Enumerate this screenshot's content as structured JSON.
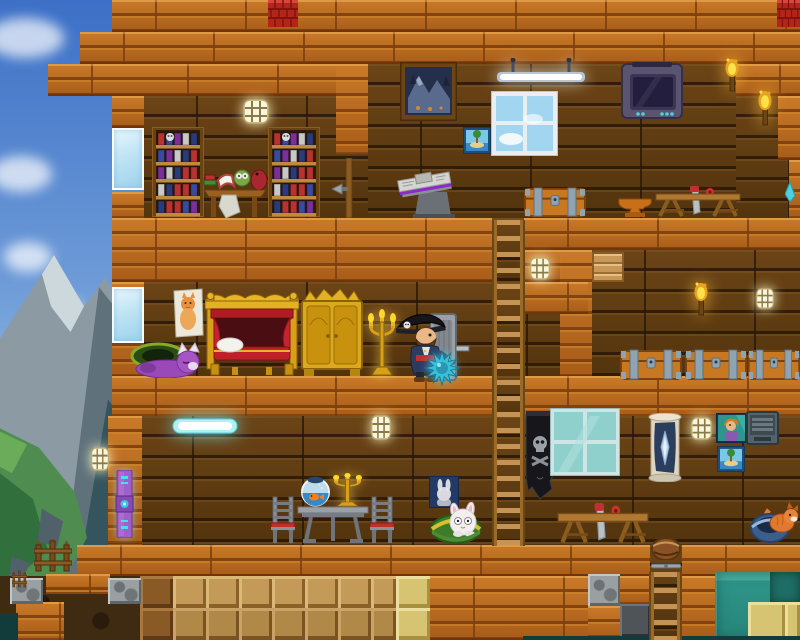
{
  "meta": {
    "canvas": {
      "w": 800,
      "h": 640
    }
  },
  "palette": {
    "sky_top": "#3c70c6",
    "sky_bottom": "#bfdaee",
    "cabin_wood": "#b3671f",
    "cabin_wood_light": "#c97a28",
    "cabin_wood_dark": "#7d3f0e",
    "dark_wall_wood": "#5f3d12",
    "roof_red": "#b42418",
    "gold": "#e2b222",
    "royal_red": "#b01c24",
    "steel_blue": "#8fa3b0",
    "water_teal": "#2e9488",
    "sand_tan": "#c49a58",
    "sandstone_yellow": "#d6c472",
    "stone_gray": "#9aa0a2",
    "glass_blue": "#bfe4f4",
    "lamp_white": "#faf6dc",
    "flame_yellow": "#ffe14a",
    "neon_cyan": "#48e0e8",
    "mace_cyan": "#38c0da",
    "pet_purple": "#9a4ab8",
    "banner_black": "#17171b",
    "tv_purple": "#5a5470"
  },
  "scene": {
    "bg": [
      {
        "t": "cloud",
        "x": -14,
        "y": 18,
        "w": 78,
        "h": 40
      },
      {
        "t": "cloud",
        "x": -10,
        "y": 156,
        "w": 62,
        "h": 36
      },
      {
        "t": "cloud",
        "x": 4,
        "y": 242,
        "w": 48,
        "h": 30
      },
      {
        "t": "cloud",
        "x": 40,
        "y": 298,
        "w": 42,
        "h": 24
      },
      {
        "t": "cloud",
        "x": -18,
        "y": 380,
        "w": 96,
        "h": 56
      },
      {
        "t": "poly",
        "x": 0,
        "y": 255,
        "w": 150,
        "h": 321,
        "c": "#8c9aa4",
        "pts": "0% 26%, 36% 0%, 56% 16%, 70% 7%, 100% 30%, 100% 100%, 0% 100%"
      },
      {
        "t": "poly",
        "x": 0,
        "y": 255,
        "w": 150,
        "h": 321,
        "c": "#cdd8dc",
        "pts": "28% 6%, 36% 0%, 56% 16%, 47% 24%, 34% 16%"
      },
      {
        "t": "poly",
        "x": 0,
        "y": 255,
        "w": 150,
        "h": 321,
        "c": "#5f727c",
        "pts": "66% 10%, 100% 30%, 100% 100%, 42% 100%"
      },
      {
        "t": "poly",
        "x": 0,
        "y": 255,
        "w": 150,
        "h": 321,
        "c": "#35555e",
        "pts": "72% 45%, 100% 62%, 100% 100%, 52% 100%"
      },
      {
        "t": "poly",
        "x": 0,
        "y": 255,
        "w": 150,
        "h": 321,
        "c": "#4e8c50",
        "pts": "0% 54%, 26% 60%, 50% 74%, 58% 88%, 44% 100%, 0% 100%"
      },
      {
        "t": "poly",
        "x": 0,
        "y": 255,
        "w": 150,
        "h": 321,
        "c": "#31703c",
        "pts": "0% 68%, 22% 76%, 32% 92%, 12% 100%, 0% 100%"
      },
      {
        "t": "poly",
        "x": 0,
        "y": 255,
        "w": 150,
        "h": 321,
        "c": "#6aac5a",
        "pts": "0% 55%, 18% 59%, 8% 68%, 0% 66%"
      },
      {
        "t": "poly",
        "x": 0,
        "y": 255,
        "w": 150,
        "h": 321,
        "c": "#50616c",
        "pts": "28% 79%, 42% 83%, 38% 91%, 25% 89%"
      },
      {
        "t": "poly",
        "x": 0,
        "y": 255,
        "w": 150,
        "h": 321,
        "c": "#50616c",
        "pts": "8% 94%, 20% 96%, 16% 100%, 6% 100%"
      }
    ],
    "blocks": [
      {
        "t": "darkwood",
        "x": 144,
        "y": 96,
        "w": 192,
        "h": 122
      },
      {
        "t": "darkwood",
        "x": 368,
        "y": 64,
        "w": 368,
        "h": 154
      },
      {
        "t": "darkwood",
        "x": 736,
        "y": 96,
        "w": 53,
        "h": 122
      },
      {
        "t": "darkwood",
        "x": 336,
        "y": 96,
        "w": 32,
        "h": 122
      },
      {
        "t": "darkwood",
        "x": 144,
        "y": 282,
        "w": 416,
        "h": 94
      },
      {
        "t": "darkwood",
        "x": 592,
        "y": 250,
        "w": 208,
        "h": 130
      },
      {
        "t": "darkwood",
        "x": 140,
        "y": 416,
        "w": 660,
        "h": 129
      },
      {
        "t": "darkdirt",
        "x": 0,
        "y": 576,
        "w": 144,
        "h": 64
      },
      {
        "t": "wood",
        "x": 112,
        "y": 0,
        "w": 688,
        "h": 32
      },
      {
        "t": "wood",
        "x": 80,
        "y": 32,
        "w": 720,
        "h": 32
      },
      {
        "t": "wood",
        "x": 48,
        "y": 64,
        "w": 96,
        "h": 32
      },
      {
        "t": "wood",
        "x": 144,
        "y": 64,
        "w": 224,
        "h": 32
      },
      {
        "t": "wood",
        "x": 336,
        "y": 64,
        "w": 32,
        "h": 90
      },
      {
        "t": "wood",
        "x": 736,
        "y": 64,
        "w": 64,
        "h": 32
      },
      {
        "t": "wood",
        "x": 778,
        "y": 96,
        "w": 22,
        "h": 64
      },
      {
        "t": "wood",
        "x": 789,
        "y": 160,
        "w": 11,
        "h": 58
      },
      {
        "t": "wood",
        "x": 112,
        "y": 96,
        "w": 32,
        "h": 32
      },
      {
        "t": "wood",
        "x": 112,
        "y": 192,
        "w": 32,
        "h": 26
      },
      {
        "t": "wood",
        "x": 112,
        "y": 218,
        "w": 380,
        "h": 64
      },
      {
        "t": "wood",
        "x": 524,
        "y": 218,
        "w": 276,
        "h": 32
      },
      {
        "t": "wood",
        "x": 524,
        "y": 250,
        "w": 68,
        "h": 32
      },
      {
        "t": "wood",
        "x": 560,
        "y": 250,
        "w": 32,
        "h": 126
      },
      {
        "t": "wood",
        "x": 524,
        "y": 282,
        "w": 64,
        "h": 32
      },
      {
        "t": "wood",
        "x": 112,
        "y": 282,
        "w": 32,
        "h": 94
      },
      {
        "t": "wood",
        "x": 112,
        "y": 376,
        "w": 380,
        "h": 40
      },
      {
        "t": "wood",
        "x": 524,
        "y": 376,
        "w": 276,
        "h": 40
      },
      {
        "t": "wood",
        "x": 108,
        "y": 416,
        "w": 34,
        "h": 129
      },
      {
        "t": "wood",
        "x": 77,
        "y": 545,
        "w": 573,
        "h": 31
      },
      {
        "t": "wood",
        "x": 682,
        "y": 545,
        "w": 118,
        "h": 31
      },
      {
        "t": "wood",
        "x": 430,
        "y": 576,
        "w": 160,
        "h": 64
      },
      {
        "t": "wood",
        "x": 588,
        "y": 606,
        "w": 32,
        "h": 34
      },
      {
        "t": "wood",
        "x": 620,
        "y": 576,
        "w": 30,
        "h": 28
      },
      {
        "t": "wood",
        "x": 682,
        "y": 576,
        "w": 33,
        "h": 64
      },
      {
        "t": "wood",
        "x": 46,
        "y": 574,
        "w": 64,
        "h": 20
      },
      {
        "t": "wood",
        "x": 16,
        "y": 602,
        "w": 48,
        "h": 38
      },
      {
        "t": "darkwood",
        "x": 492,
        "y": 218,
        "w": 32,
        "h": 64
      },
      {
        "t": "darkwood",
        "x": 492,
        "y": 376,
        "w": 32,
        "h": 40
      },
      {
        "t": "darkwood",
        "x": 650,
        "y": 545,
        "w": 32,
        "h": 95
      },
      {
        "t": "glass",
        "x": 112,
        "y": 128,
        "w": 32,
        "h": 62
      },
      {
        "t": "glass",
        "x": 112,
        "y": 287,
        "w": 32,
        "h": 56
      },
      {
        "t": "platform",
        "x": 592,
        "y": 252,
        "w": 32,
        "h": 30
      },
      {
        "t": "dirtb",
        "x": 140,
        "y": 576,
        "w": 33,
        "h": 32
      },
      {
        "t": "sandb",
        "x": 173,
        "y": 576,
        "w": 33,
        "h": 32
      },
      {
        "t": "sandb",
        "x": 206,
        "y": 576,
        "w": 33,
        "h": 32
      },
      {
        "t": "sandb",
        "x": 239,
        "y": 576,
        "w": 33,
        "h": 32
      },
      {
        "t": "sandb",
        "x": 272,
        "y": 576,
        "w": 33,
        "h": 32
      },
      {
        "t": "sandb",
        "x": 305,
        "y": 576,
        "w": 33,
        "h": 32
      },
      {
        "t": "sandb",
        "x": 338,
        "y": 576,
        "w": 33,
        "h": 32
      },
      {
        "t": "sandb",
        "x": 371,
        "y": 576,
        "w": 25,
        "h": 32
      },
      {
        "t": "sandy",
        "x": 396,
        "y": 576,
        "w": 34,
        "h": 32
      },
      {
        "t": "dirtb",
        "x": 140,
        "y": 608,
        "w": 33,
        "h": 32
      },
      {
        "t": "sandb2",
        "x": 173,
        "y": 608,
        "w": 33,
        "h": 32
      },
      {
        "t": "sandb2",
        "x": 206,
        "y": 608,
        "w": 33,
        "h": 32
      },
      {
        "t": "sandb2",
        "x": 239,
        "y": 608,
        "w": 33,
        "h": 32
      },
      {
        "t": "sandb2",
        "x": 272,
        "y": 608,
        "w": 33,
        "h": 32
      },
      {
        "t": "sandb2",
        "x": 305,
        "y": 608,
        "w": 33,
        "h": 32
      },
      {
        "t": "sandb2",
        "x": 338,
        "y": 608,
        "w": 33,
        "h": 32
      },
      {
        "t": "sandb2",
        "x": 371,
        "y": 608,
        "w": 25,
        "h": 32
      },
      {
        "t": "sandy",
        "x": 396,
        "y": 608,
        "w": 34,
        "h": 32
      },
      {
        "t": "water",
        "x": 715,
        "y": 572,
        "w": 85,
        "h": 68
      },
      {
        "t": "waterd",
        "x": 770,
        "y": 572,
        "w": 30,
        "h": 31
      },
      {
        "t": "sandy",
        "x": 748,
        "y": 602,
        "w": 37,
        "h": 38
      },
      {
        "t": "sandy",
        "x": 785,
        "y": 602,
        "w": 15,
        "h": 38
      },
      {
        "t": "stone",
        "x": 10,
        "y": 578,
        "w": 33,
        "h": 26
      },
      {
        "t": "stone",
        "x": 108,
        "y": 578,
        "w": 33,
        "h": 26
      },
      {
        "t": "stone",
        "x": 588,
        "y": 574,
        "w": 32,
        "h": 32
      },
      {
        "t": "darkstone",
        "x": 620,
        "y": 604,
        "w": 30,
        "h": 33
      },
      {
        "t": "deep",
        "x": 523,
        "y": 636,
        "w": 277,
        "h": 4
      },
      {
        "t": "deep",
        "x": 0,
        "y": 613,
        "w": 18,
        "h": 27
      }
    ],
    "objects": [
      {
        "t": "roof",
        "x": 268,
        "y": 0,
        "w": 30,
        "h": 27
      },
      {
        "t": "roof",
        "x": 777,
        "y": 0,
        "w": 23,
        "h": 27
      },
      {
        "t": "pole",
        "x": 344,
        "y": 158,
        "w": 10,
        "h": 60
      },
      {
        "t": "spear",
        "x": 332,
        "y": 183,
        "w": 16,
        "h": 12
      },
      {
        "t": "shard",
        "x": 785,
        "y": 182,
        "w": 10,
        "h": 20
      },
      {
        "t": "lamp",
        "x": 243,
        "y": 99,
        "w": 26,
        "h": 25
      },
      {
        "t": "lamp",
        "x": 530,
        "y": 257,
        "w": 20,
        "h": 23
      },
      {
        "t": "lamp",
        "x": 756,
        "y": 288,
        "w": 18,
        "h": 21
      },
      {
        "t": "lamp",
        "x": 371,
        "y": 415,
        "w": 20,
        "h": 25
      },
      {
        "t": "lamp",
        "x": 691,
        "y": 417,
        "w": 21,
        "h": 23
      },
      {
        "t": "lamp",
        "x": 91,
        "y": 447,
        "w": 18,
        "h": 24
      },
      {
        "t": "torch",
        "x": 722,
        "y": 58,
        "w": 20,
        "h": 34
      },
      {
        "t": "torch",
        "x": 755,
        "y": 90,
        "w": 20,
        "h": 36
      },
      {
        "t": "torch",
        "x": 691,
        "y": 282,
        "w": 20,
        "h": 34
      },
      {
        "t": "bookshelf",
        "x": 152,
        "y": 127,
        "w": 52,
        "h": 90
      },
      {
        "t": "bookshelf",
        "x": 268,
        "y": 127,
        "w": 52,
        "h": 90
      },
      {
        "t": "deskscene",
        "x": 202,
        "y": 164,
        "w": 66,
        "h": 56
      },
      {
        "t": "paintmtn",
        "x": 400,
        "y": 62,
        "w": 57,
        "h": 59
      },
      {
        "t": "paintisle",
        "x": 463,
        "y": 127,
        "w": 28,
        "h": 27
      },
      {
        "t": "paintisle",
        "x": 717,
        "y": 446,
        "w": 28,
        "h": 26
      },
      {
        "t": "skywindow",
        "x": 491,
        "y": 91,
        "w": 67,
        "h": 65
      },
      {
        "t": "shoplight",
        "x": 497,
        "y": 58,
        "w": 88,
        "h": 28
      },
      {
        "t": "tv",
        "x": 620,
        "y": 60,
        "w": 64,
        "h": 62
      },
      {
        "t": "newsstand",
        "x": 393,
        "y": 170,
        "w": 68,
        "h": 48
      },
      {
        "t": "chest",
        "x": 524,
        "y": 186,
        "w": 62,
        "h": 31
      },
      {
        "t": "chest",
        "x": 620,
        "y": 348,
        "w": 62,
        "h": 32
      },
      {
        "t": "chest",
        "x": 685,
        "y": 348,
        "w": 62,
        "h": 32
      },
      {
        "t": "chest",
        "x": 748,
        "y": 348,
        "w": 52,
        "h": 32
      },
      {
        "t": "anvil",
        "x": 615,
        "y": 195,
        "w": 40,
        "h": 23
      },
      {
        "t": "sawhorse",
        "x": 654,
        "y": 186,
        "w": 88,
        "h": 32
      },
      {
        "t": "sawhorse",
        "x": 556,
        "y": 503,
        "w": 94,
        "h": 42
      },
      {
        "t": "ladder",
        "x": 492,
        "y": 220,
        "w": 33,
        "h": 326
      },
      {
        "t": "ladder",
        "x": 649,
        "y": 572,
        "w": 33,
        "h": 68
      },
      {
        "t": "latch",
        "x": 651,
        "y": 546,
        "w": 30,
        "h": 8
      },
      {
        "t": "latch",
        "x": 651,
        "y": 562,
        "w": 30,
        "h": 8
      },
      {
        "t": "barrel",
        "x": 651,
        "y": 536,
        "w": 30,
        "h": 24
      },
      {
        "t": "door",
        "x": 430,
        "y": 312,
        "w": 40,
        "h": 70
      },
      {
        "t": "catposter",
        "x": 173,
        "y": 288,
        "w": 31,
        "h": 50
      },
      {
        "t": "bed",
        "x": 205,
        "y": 291,
        "w": 94,
        "h": 85
      },
      {
        "t": "wardrobe",
        "x": 300,
        "y": 289,
        "w": 64,
        "h": 87
      },
      {
        "t": "candelabra",
        "x": 366,
        "y": 307,
        "w": 32,
        "h": 70
      },
      {
        "t": "candelabra",
        "x": 331,
        "y": 472,
        "w": 33,
        "h": 35
      },
      {
        "t": "purplecat",
        "x": 128,
        "y": 342,
        "w": 76,
        "h": 36
      },
      {
        "t": "cyanbar",
        "x": 172,
        "y": 416,
        "w": 66,
        "h": 20
      },
      {
        "t": "skullbanner",
        "x": 526,
        "y": 411,
        "w": 28,
        "h": 90
      },
      {
        "t": "tealwindow",
        "x": 550,
        "y": 408,
        "w": 70,
        "h": 68
      },
      {
        "t": "scroll",
        "x": 647,
        "y": 413,
        "w": 36,
        "h": 69
      },
      {
        "t": "portrait",
        "x": 716,
        "y": 413,
        "w": 31,
        "h": 30
      },
      {
        "t": "locker",
        "x": 746,
        "y": 410,
        "w": 33,
        "h": 35
      },
      {
        "t": "bunnyposter",
        "x": 429,
        "y": 476,
        "w": 30,
        "h": 32
      },
      {
        "t": "techpanel",
        "x": 115,
        "y": 470,
        "w": 19,
        "h": 68
      },
      {
        "t": "chair",
        "x": 267,
        "y": 495,
        "w": 32,
        "h": 48
      },
      {
        "t": "chair",
        "x": 366,
        "y": 495,
        "w": 32,
        "h": 48
      },
      {
        "t": "dtable",
        "x": 296,
        "y": 505,
        "w": 74,
        "h": 38
      },
      {
        "t": "fishbowl",
        "x": 300,
        "y": 475,
        "w": 31,
        "h": 32
      },
      {
        "t": "bunnybasket",
        "x": 430,
        "y": 502,
        "w": 62,
        "h": 42
      },
      {
        "t": "foxbasket",
        "x": 750,
        "y": 502,
        "w": 50,
        "h": 42
      },
      {
        "t": "fence",
        "x": 34,
        "y": 539,
        "w": 38,
        "h": 34
      },
      {
        "t": "fence",
        "x": 12,
        "y": 570,
        "w": 15,
        "h": 18
      },
      {
        "t": "pirate",
        "x": 392,
        "y": 310,
        "w": 64,
        "h": 72
      },
      {
        "t": "mace",
        "x": 424,
        "y": 350,
        "w": 36,
        "h": 36
      }
    ]
  }
}
